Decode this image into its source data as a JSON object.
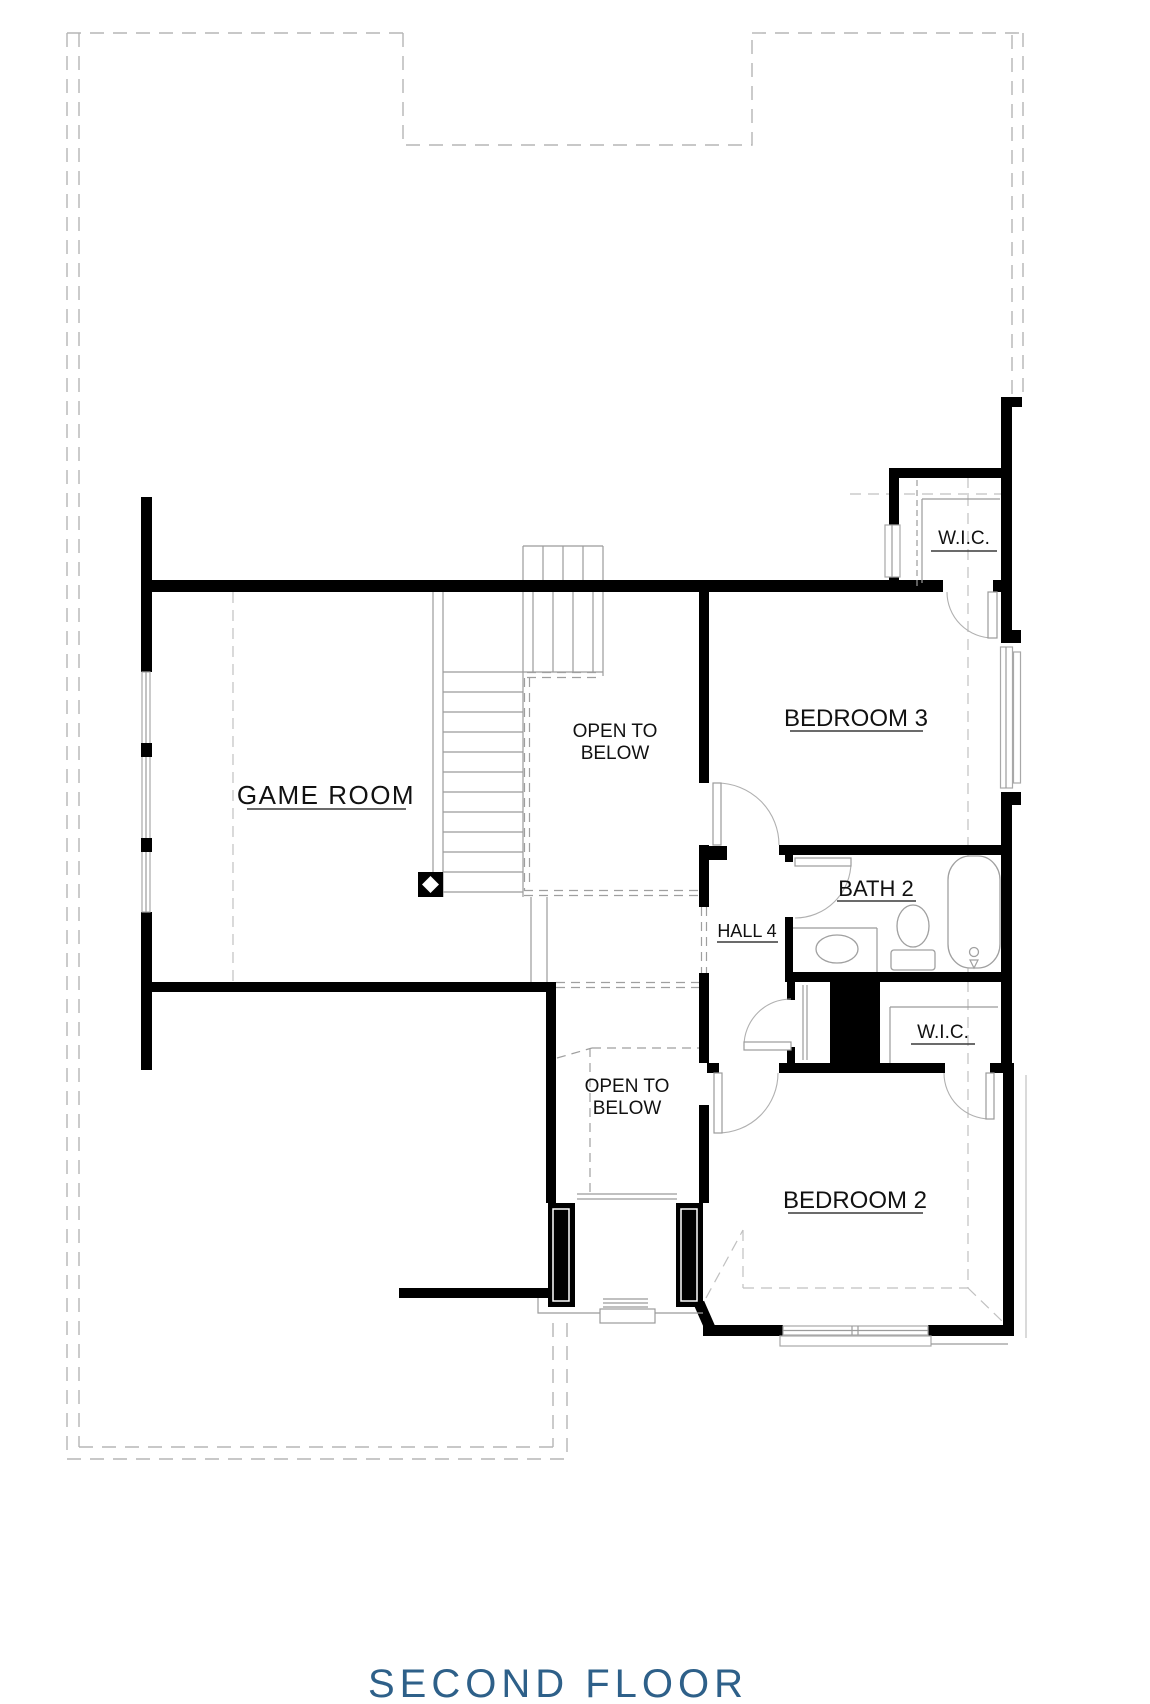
{
  "title": "SECOND FLOOR",
  "rooms": {
    "game_room": "GAME ROOM",
    "bedroom3": "BEDROOM 3",
    "bedroom2": "BEDROOM 2",
    "bath2": "BATH 2",
    "hall4": "HALL 4",
    "wic_top": "W.I.C.",
    "wic_bottom": "W.I.C.",
    "open_below_top": {
      "line1": "OPEN TO",
      "line2": "BELOW"
    },
    "open_below_bottom": {
      "line1": "OPEN TO",
      "line2": "BELOW"
    }
  },
  "colors": {
    "background": "#ffffff",
    "walls": "#000000",
    "thin_lines": "#9b9b9b",
    "dashed_outline": "#b5b5b5",
    "label_text": "#111111",
    "title_text": "#2e6089"
  }
}
